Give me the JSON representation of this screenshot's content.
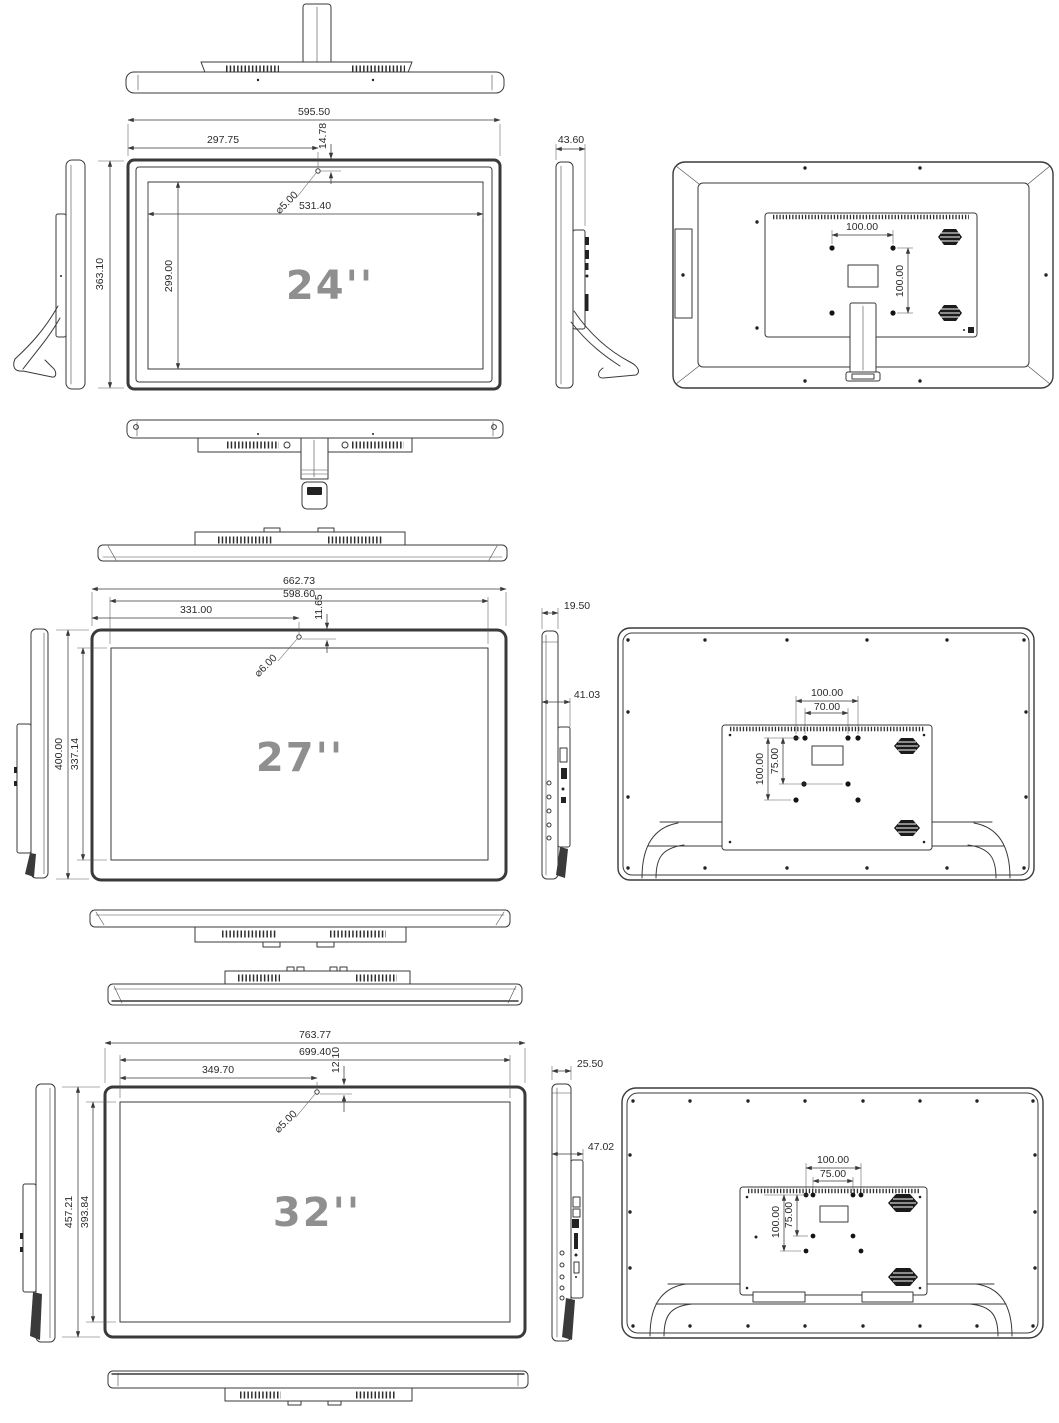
{
  "page": {
    "background": "#ffffff",
    "line_color": "#3a3a3a",
    "size_label_color": "#8f8f8f"
  },
  "models": {
    "m24": {
      "size_label": "24''",
      "front": {
        "total_width": "595.50",
        "half_width": "297.75",
        "top_hole_offset": "14.78",
        "hole_diameter": "⌀5.00",
        "screen_width": "531.40",
        "screen_height": "299.00",
        "total_height": "363.10"
      },
      "side": {
        "depth": "43.60"
      },
      "back": {
        "vesa_width": "100.00",
        "vesa_height": "100.00"
      }
    },
    "m27": {
      "size_label": "27''",
      "front": {
        "total_width": "662.73",
        "screen_width_dim": "598.60",
        "half_width": "331.00",
        "top_hole_offset": "11.65",
        "hole_diameter": "⌀6.00",
        "total_height": "400.00",
        "screen_height": "337.14"
      },
      "side": {
        "front_thickness": "19.50",
        "total_depth": "41.03"
      },
      "back": {
        "vesa_width_outer": "100.00",
        "vesa_width_inner": "70.00",
        "vesa_height_outer": "100.00",
        "vesa_height_inner": "75.00"
      }
    },
    "m32": {
      "size_label": "32''",
      "front": {
        "total_width": "763.77",
        "screen_width_dim": "699.40",
        "half_width": "349.70",
        "top_hole_offset": "12.10",
        "hole_diameter": "⌀5.00",
        "total_height": "457.21",
        "screen_height": "393.84"
      },
      "side": {
        "front_thickness": "25.50",
        "total_depth": "47.02"
      },
      "back": {
        "vesa_width_outer": "100.00",
        "vesa_width_inner": "75.00",
        "vesa_height_outer": "100.00",
        "vesa_height_inner": "75.00"
      }
    }
  }
}
